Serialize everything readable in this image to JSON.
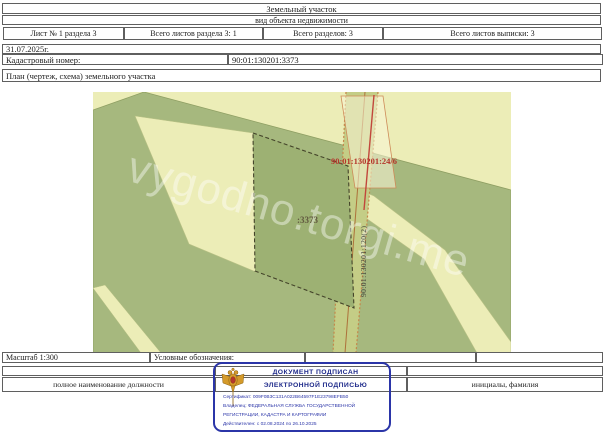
{
  "doc": {
    "title": "Земельный участок",
    "subtitle": "вид объекта недвижимости",
    "meta_cells": [
      "Лист № 1 раздела 3",
      "Всего листов раздела 3: 1",
      "Всего разделов: 3",
      "Всего листов выписки: 3"
    ],
    "date": "31.07.2025г.",
    "cadastral_label": "Кадастровый номер:",
    "cadastral_value": "90:01:130201:3373",
    "plan_header": "План (чертеж, схема) земельного участка",
    "scale_label": "Масштаб 1:300",
    "legend_label": "Условные обозначения:",
    "footer_position_label": "полное наименование должности",
    "footer_name_label": "инициалы, фамилия"
  },
  "map": {
    "parcel_label": ":3373",
    "neighbor_label": "90:01:130201:24/6",
    "vertical_label": "90:01:130201:120(2)",
    "watermark": "vygodno.torgi.me",
    "colors": {
      "background": "#ecedb7",
      "olive": "#a6b87e",
      "parcel_fill": "#9db173",
      "strip_fill": "#c4cd86",
      "strip_edge": "#c4874a",
      "red_line": "#c2473c",
      "neighbor_label_color": "#b5352b"
    }
  },
  "stamp": {
    "line1": "ДОКУМЕНТ ПОДПИСАН",
    "line2": "ЭЛЕКТРОННОЙ ПОДПИСЬЮ",
    "certificate": "Сертификат: 009F0B3C131A022B64597F1E23798EFB50",
    "owner_line1": "Владелец: ФЕДЕРАЛЬНАЯ СЛУЖБА ГОСУДАРСТВЕННОЙ",
    "owner_line2": "РЕГИСТРАЦИИ, КАДАСТРА И КАРТОГРАФИИ",
    "validity": "Действителен: с 02.08.2024 по 26.10.2025",
    "border_color": "#2b35a8"
  }
}
